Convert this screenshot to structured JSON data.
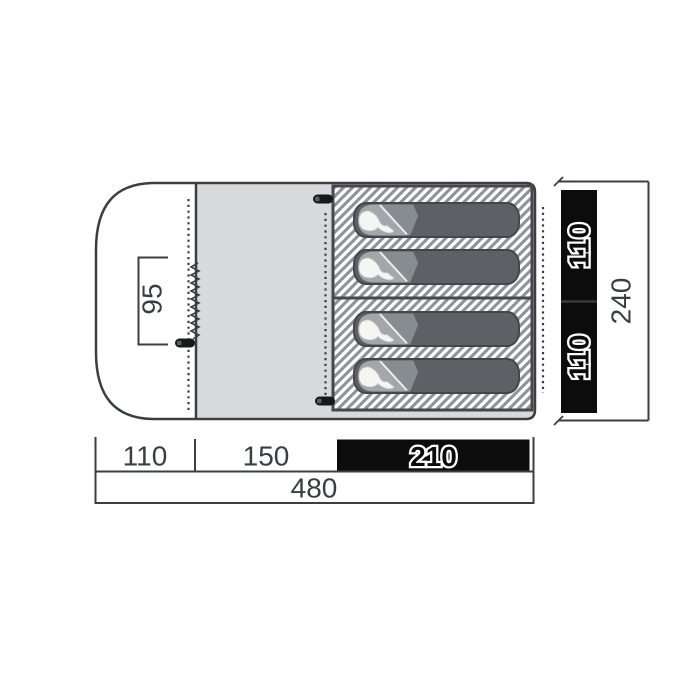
{
  "diagram": {
    "name": "tent floor plan with sleeping cabins",
    "dims": {
      "door": "95",
      "porch": "110",
      "living": "150",
      "sleeping": "210",
      "total_length": "480",
      "cabin_top": "110",
      "cabin_bottom": "110",
      "total_depth": "240"
    },
    "sleeping_bag_count": "4",
    "colors": {
      "floor": "#d8d9da",
      "outline": "#3b3e43",
      "highlight_bar": "#0c0c0c",
      "hatch_stripe": "#8e9297",
      "bag_body": "#5d6166",
      "bag_hood": "#a2a7ac",
      "bag_flap": "#878c91"
    }
  }
}
